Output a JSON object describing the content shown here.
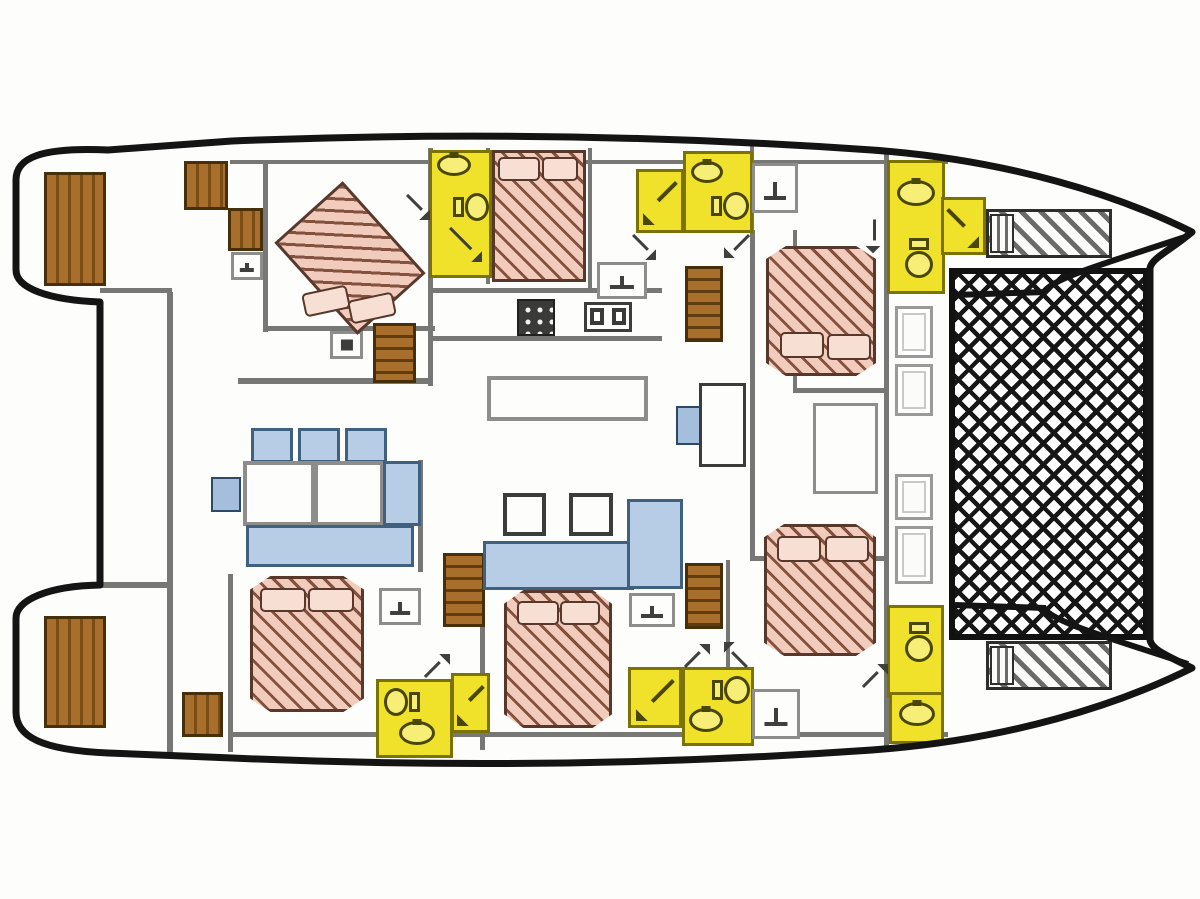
{
  "palette": {
    "wall": "#777775",
    "gray-line": "#8d8d8b",
    "dark-line": "#3c3c3a",
    "yellow": "#f0e22a",
    "yellow-lt": "#f6ee77",
    "yellow-line": "#7c7200",
    "glyph-y": "#4a4706",
    "glyph-g": "#3f3f3d",
    "blue": "#b7cde6",
    "blue-line": "#40607f",
    "window": "#a4bedc",
    "window-line": "#2c4a68",
    "bed": "#f1cbbc",
    "bed-stripe": "#84513f",
    "bed-line": "#59382c",
    "pillow": "#f7dfd4",
    "hull": "#141414"
  },
  "plan": {
    "width": 1200,
    "height": 899,
    "items": [
      {
        "n": "wall-top-deck",
        "t": "wall",
        "x": 230,
        "y": 160,
        "w": 718,
        "h": 4
      },
      {
        "n": "wall-fwd-port-cabin-left",
        "t": "wall",
        "x": 263,
        "y": 162,
        "w": 5,
        "h": 170
      },
      {
        "n": "wall-fwd-port-cabin-bottom",
        "t": "wall",
        "x": 263,
        "y": 326,
        "w": 172,
        "h": 5
      },
      {
        "n": "wall-mid-vertical",
        "t": "wall",
        "x": 428,
        "y": 148,
        "w": 5,
        "h": 238
      },
      {
        "n": "wall-port-lower",
        "t": "wall",
        "x": 238,
        "y": 378,
        "w": 194,
        "h": 6
      },
      {
        "n": "wall-stern-upper",
        "t": "wall",
        "x": 100,
        "y": 288,
        "w": 72,
        "h": 5
      },
      {
        "n": "wall-salon-left",
        "t": "wall",
        "x": 167,
        "y": 292,
        "w": 6,
        "h": 462
      },
      {
        "n": "wall-center-bed-right",
        "t": "wall",
        "x": 588,
        "y": 148,
        "w": 4,
        "h": 142
      },
      {
        "n": "wall-galley-top",
        "t": "wall",
        "x": 430,
        "y": 288,
        "w": 232,
        "h": 5
      },
      {
        "n": "wall-galley-bottom",
        "t": "wall",
        "x": 430,
        "y": 336,
        "w": 232,
        "h": 5
      },
      {
        "n": "wall-stbd-corridor-left",
        "t": "wall",
        "x": 750,
        "y": 230,
        "w": 5,
        "h": 330
      },
      {
        "n": "wall-stbd-corridor-right",
        "t": "wall",
        "x": 793,
        "y": 230,
        "w": 4,
        "h": 162
      },
      {
        "n": "wall-stbd-outer",
        "t": "wall",
        "x": 884,
        "y": 152,
        "w": 5,
        "h": 600
      },
      {
        "n": "wall-fwd-stbd-cabin-left",
        "t": "wall",
        "x": 750,
        "y": 140,
        "w": 4,
        "h": 95
      },
      {
        "n": "wall-stbd-mid-room-top",
        "t": "wall",
        "x": 793,
        "y": 388,
        "w": 95,
        "h": 5
      },
      {
        "n": "wall-aft-stbd-room-top",
        "t": "wall",
        "x": 750,
        "y": 556,
        "w": 138,
        "h": 5
      },
      {
        "n": "wall-aft-port-cabin-left",
        "t": "wall",
        "x": 228,
        "y": 574,
        "w": 5,
        "h": 178
      },
      {
        "n": "wall-bottom-deck",
        "t": "wall",
        "x": 228,
        "y": 732,
        "w": 720,
        "h": 5
      },
      {
        "n": "wall-aft-center-cabin-left",
        "t": "wall",
        "x": 480,
        "y": 590,
        "w": 5,
        "h": 160
      },
      {
        "n": "wall-aft-stbd-stairwell",
        "t": "wall",
        "x": 726,
        "y": 560,
        "w": 4,
        "h": 172
      },
      {
        "n": "wall-stern-lower",
        "t": "wall",
        "x": 100,
        "y": 582,
        "w": 72,
        "h": 6
      },
      {
        "n": "wall-fwd-bath-right",
        "t": "wall",
        "x": 486,
        "y": 148,
        "w": 4,
        "h": 136
      },
      {
        "n": "wall-dinette-right",
        "t": "wall",
        "x": 418,
        "y": 460,
        "w": 5,
        "h": 112
      },
      {
        "n": "wall-stbd-fwd-bath-divider",
        "t": "wall",
        "x": 887,
        "y": 232,
        "w": 58,
        "h": 4
      },
      {
        "n": "wall-stbd-aft-bath-divider",
        "t": "wall",
        "x": 887,
        "y": 692,
        "w": 57,
        "h": 4
      },
      {
        "n": "bathroom-fwd-port",
        "t": "bath-room",
        "x": 429,
        "y": 150,
        "w": 63,
        "h": 128
      },
      {
        "n": "shower-fwd-center",
        "t": "shower-room",
        "x": 636,
        "y": 169,
        "w": 48,
        "h": 64,
        "f": true
      },
      {
        "n": "bathroom-fwd-center",
        "t": "bath-room",
        "x": 683,
        "y": 151,
        "w": 70,
        "h": 82
      },
      {
        "n": "bathroom-fwd-stbd",
        "t": "bath-room",
        "x": 887,
        "y": 160,
        "w": 58,
        "h": 134
      },
      {
        "n": "shower-fwd-stbd",
        "t": "shower-room",
        "x": 941,
        "y": 197,
        "w": 45,
        "h": 58
      },
      {
        "n": "bathroom-aft-port",
        "t": "bath-room",
        "x": 376,
        "y": 679,
        "w": 77,
        "h": 79
      },
      {
        "n": "shower-aft-port",
        "t": "shower-room",
        "x": 451,
        "y": 673,
        "w": 39,
        "h": 60,
        "f": true
      },
      {
        "n": "shower-aft-center",
        "t": "shower-room",
        "x": 628,
        "y": 667,
        "w": 54,
        "h": 61,
        "f": true
      },
      {
        "n": "bathroom-aft-center",
        "t": "bath-room",
        "x": 682,
        "y": 667,
        "w": 72,
        "h": 79
      },
      {
        "n": "bathroom-aft-stbd",
        "t": "bath-room",
        "x": 887,
        "y": 605,
        "w": 57,
        "h": 92
      },
      {
        "n": "washroom-aft-stbd",
        "t": "bath-room",
        "x": 889,
        "y": 692,
        "w": 55,
        "h": 52
      },
      {
        "n": "toilet-fwd-port",
        "t": "toilet",
        "x": 453,
        "y": 193,
        "w": 36,
        "h": 28
      },
      {
        "n": "sink-fwd-port",
        "t": "sink-oval",
        "x": 437,
        "y": 154,
        "w": 34,
        "h": 22
      },
      {
        "n": "toilet-fwd-center",
        "t": "toilet",
        "x": 711,
        "y": 192,
        "w": 38,
        "h": 28
      },
      {
        "n": "sink-fwd-center",
        "t": "sink-oval",
        "x": 691,
        "y": 161,
        "w": 32,
        "h": 22
      },
      {
        "n": "toilet-fwd-stbd",
        "t": "toilet",
        "x": 899,
        "y": 244,
        "w": 40,
        "h": 28,
        "r": 90
      },
      {
        "n": "sink-fwd-stbd",
        "t": "sink-oval",
        "x": 897,
        "y": 180,
        "w": 38,
        "h": 26
      },
      {
        "n": "toilet-aft-port",
        "t": "toilet",
        "x": 384,
        "y": 688,
        "w": 36,
        "h": 28,
        "r": 180
      },
      {
        "n": "sink-aft-port",
        "t": "sink-oval",
        "x": 399,
        "y": 721,
        "w": 36,
        "h": 24
      },
      {
        "n": "toilet-aft-center",
        "t": "toilet",
        "x": 712,
        "y": 676,
        "w": 38,
        "h": 28
      },
      {
        "n": "sink-aft-center",
        "t": "sink-oval",
        "x": 689,
        "y": 708,
        "w": 34,
        "h": 24
      },
      {
        "n": "toilet-aft-stbd",
        "t": "toilet",
        "x": 899,
        "y": 628,
        "w": 40,
        "h": 28,
        "r": 90
      },
      {
        "n": "sink-aft-stbd",
        "t": "sink-oval",
        "x": 899,
        "y": 702,
        "w": 36,
        "h": 24
      },
      {
        "n": "swim-platform-port",
        "t": "wood",
        "x": 44,
        "y": 172,
        "w": 62,
        "h": 114
      },
      {
        "n": "steps-port-aft-1",
        "t": "wood",
        "x": 184,
        "y": 161,
        "w": 44,
        "h": 49
      },
      {
        "n": "steps-port-aft-2",
        "t": "wood",
        "x": 228,
        "y": 208,
        "w": 35,
        "h": 43
      },
      {
        "n": "stairs-port-fwd",
        "t": "stairs",
        "x": 373,
        "y": 323,
        "w": 43,
        "h": 60
      },
      {
        "n": "stairs-stbd-fwd",
        "t": "stairs",
        "x": 685,
        "y": 266,
        "w": 38,
        "h": 76
      },
      {
        "n": "stairs-port-aft",
        "t": "stairs",
        "x": 443,
        "y": 553,
        "w": 42,
        "h": 74
      },
      {
        "n": "stairs-stbd-aft",
        "t": "stairs",
        "x": 685,
        "y": 563,
        "w": 38,
        "h": 66
      },
      {
        "n": "swim-platform-stbd",
        "t": "wood",
        "x": 44,
        "y": 616,
        "w": 62,
        "h": 112
      },
      {
        "n": "steps-stbd-aft",
        "t": "wood",
        "x": 182,
        "y": 692,
        "w": 41,
        "h": 45
      },
      {
        "n": "trampoline-net",
        "t": "net",
        "x": 949,
        "y": 268,
        "w": 200,
        "h": 372
      },
      {
        "n": "bow-lounger-top",
        "t": "lounger",
        "x": 986,
        "y": 209,
        "w": 126,
        "h": 49
      },
      {
        "n": "bow-lounger-top-end",
        "t": "lounger-end",
        "x": 990,
        "y": 214,
        "w": 24,
        "h": 39
      },
      {
        "n": "bow-lounger-bottom",
        "t": "lounger",
        "x": 986,
        "y": 641,
        "w": 126,
        "h": 49
      },
      {
        "n": "bow-lounger-bottom-end",
        "t": "lounger-end",
        "x": 990,
        "y": 646,
        "w": 24,
        "h": 39
      },
      {
        "n": "deck-hatch-1",
        "t": "hatch",
        "x": 895,
        "y": 306,
        "w": 38,
        "h": 52
      },
      {
        "n": "deck-hatch-2",
        "t": "hatch",
        "x": 895,
        "y": 364,
        "w": 38,
        "h": 52
      },
      {
        "n": "deck-hatch-3",
        "t": "hatch",
        "x": 895,
        "y": 474,
        "w": 38,
        "h": 46
      },
      {
        "n": "deck-hatch-4",
        "t": "hatch",
        "x": 895,
        "y": 526,
        "w": 38,
        "h": 58
      },
      {
        "n": "dinette-seatback-1",
        "t": "blue",
        "x": 251,
        "y": 428,
        "w": 42,
        "h": 35
      },
      {
        "n": "dinette-seatback-2",
        "t": "blue",
        "x": 298,
        "y": 428,
        "w": 42,
        "h": 35
      },
      {
        "n": "dinette-seatback-3",
        "t": "blue",
        "x": 345,
        "y": 428,
        "w": 42,
        "h": 35
      },
      {
        "n": "dinette-table-left",
        "t": "table",
        "x": 243,
        "y": 461,
        "w": 72,
        "h": 65
      },
      {
        "n": "dinette-table-right",
        "t": "table",
        "x": 314,
        "y": 461,
        "w": 70,
        "h": 65
      },
      {
        "n": "dinette-side-seat",
        "t": "blue",
        "x": 383,
        "y": 461,
        "w": 38,
        "h": 65
      },
      {
        "n": "dinette-bench",
        "t": "blue",
        "x": 246,
        "y": 525,
        "w": 168,
        "h": 42
      },
      {
        "n": "salon-window-port",
        "t": "window",
        "x": 211,
        "y": 477,
        "w": 30,
        "h": 35
      },
      {
        "n": "salon-bench-horizontal",
        "t": "blue",
        "x": 483,
        "y": 541,
        "w": 151,
        "h": 49
      },
      {
        "n": "salon-bench-vertical",
        "t": "blue",
        "x": 627,
        "y": 499,
        "w": 56,
        "h": 90
      },
      {
        "n": "nav-seat",
        "t": "window",
        "x": 676,
        "y": 406,
        "w": 30,
        "h": 39
      },
      {
        "n": "salon-stool-1",
        "t": "stool",
        "x": 503,
        "y": 493,
        "w": 43,
        "h": 43
      },
      {
        "n": "salon-stool-2",
        "t": "stool",
        "x": 569,
        "y": 493,
        "w": 44,
        "h": 43
      },
      {
        "n": "galley-island",
        "t": "table",
        "x": 487,
        "y": 376,
        "w": 161,
        "h": 45
      },
      {
        "n": "nav-desk",
        "t": "navdesk",
        "x": 699,
        "y": 383,
        "w": 47,
        "h": 84
      },
      {
        "n": "stbd-mid-berth",
        "t": "berth",
        "x": 813,
        "y": 403,
        "w": 65,
        "h": 91
      },
      {
        "n": "tv-locker",
        "t": "tv",
        "x": 330,
        "y": 331,
        "w": 33,
        "h": 28
      },
      {
        "n": "vanity-galley",
        "t": "vanity",
        "x": 597,
        "y": 262,
        "w": 50,
        "h": 37
      },
      {
        "n": "vanity-fwd-stbd-corridor",
        "t": "vanity",
        "x": 752,
        "y": 163,
        "w": 46,
        "h": 50
      },
      {
        "n": "vanity-aft-stbd-corridor",
        "t": "vanity",
        "x": 752,
        "y": 689,
        "w": 48,
        "h": 50
      },
      {
        "n": "vanity-aft-port-cabin",
        "t": "vanity",
        "x": 379,
        "y": 588,
        "w": 42,
        "h": 37
      },
      {
        "n": "vanity-aft-center-cabin",
        "t": "vanity",
        "x": 629,
        "y": 593,
        "w": 46,
        "h": 34
      },
      {
        "n": "vanity-cockpit",
        "t": "vanity",
        "x": 231,
        "y": 252,
        "w": 32,
        "h": 28
      },
      {
        "n": "stove",
        "t": "stove",
        "x": 517,
        "y": 299,
        "w": 38,
        "h": 37
      },
      {
        "n": "galley-double-sink",
        "t": "sink2",
        "x": 584,
        "y": 302,
        "w": 48,
        "h": 30
      },
      {
        "n": "bed-fwd-port",
        "t": "bed",
        "x": 304,
        "y": 196,
        "w": 92,
        "h": 124,
        "r": -42
      },
      {
        "n": "pillow-fwd-port-1",
        "t": "pillow",
        "x": 303,
        "y": 289,
        "w": 46,
        "h": 24,
        "r": -12
      },
      {
        "n": "pillow-fwd-port-2",
        "t": "pillow",
        "x": 349,
        "y": 296,
        "w": 46,
        "h": 24,
        "r": -12
      },
      {
        "n": "bed-fwd-center",
        "t": "bed",
        "x": 492,
        "y": 150,
        "w": 94,
        "h": 132
      },
      {
        "n": "pillow-fwd-center-1",
        "t": "pillow",
        "x": 498,
        "y": 157,
        "w": 42,
        "h": 24
      },
      {
        "n": "pillow-fwd-center-2",
        "t": "pillow",
        "x": 542,
        "y": 157,
        "w": 36,
        "h": 24
      },
      {
        "n": "bed-fwd-stbd",
        "t": "bed",
        "x": 766,
        "y": 246,
        "w": 110,
        "h": 130,
        "c": "polygon(0 10%,18% 0,82% 0,100% 10%,100% 90%,82% 100%,18% 100%,0 90%)"
      },
      {
        "n": "pillow-fwd-stbd-1",
        "t": "pillow",
        "x": 780,
        "y": 332,
        "w": 44,
        "h": 26
      },
      {
        "n": "pillow-fwd-stbd-2",
        "t": "pillow",
        "x": 827,
        "y": 334,
        "w": 44,
        "h": 26
      },
      {
        "n": "bed-aft-stbd",
        "t": "bed",
        "x": 764,
        "y": 524,
        "w": 112,
        "h": 132,
        "c": "polygon(0 10%,18% 0,82% 0,100% 10%,100% 90%,82% 100%,18% 100%,0 90%)"
      },
      {
        "n": "pillow-aft-stbd-1",
        "t": "pillow",
        "x": 777,
        "y": 536,
        "w": 44,
        "h": 26
      },
      {
        "n": "pillow-aft-stbd-2",
        "t": "pillow",
        "x": 825,
        "y": 536,
        "w": 44,
        "h": 26
      },
      {
        "n": "bed-aft-port",
        "t": "bed",
        "x": 250,
        "y": 576,
        "w": 114,
        "h": 136,
        "c": "polygon(0 10%,18% 0,82% 0,100% 10%,100% 90%,82% 100%,18% 100%,0 90%)"
      },
      {
        "n": "pillow-aft-port-1",
        "t": "pillow",
        "x": 260,
        "y": 588,
        "w": 46,
        "h": 24
      },
      {
        "n": "pillow-aft-port-2",
        "t": "pillow",
        "x": 308,
        "y": 588,
        "w": 46,
        "h": 24
      },
      {
        "n": "bed-aft-center",
        "t": "bed",
        "x": 504,
        "y": 590,
        "w": 108,
        "h": 138,
        "c": "polygon(0 10%,18% 0,82% 0,100% 10%,100% 90%,82% 100%,18% 100%,0 90%)"
      },
      {
        "n": "pillow-aft-center-1",
        "t": "pillow",
        "x": 517,
        "y": 601,
        "w": 42,
        "h": 24
      },
      {
        "n": "pillow-aft-center-2",
        "t": "pillow",
        "x": 560,
        "y": 601,
        "w": 40,
        "h": 24
      },
      {
        "n": "door-arrow-fwd-port",
        "t": "door-arrow",
        "x": 404,
        "y": 194,
        "w": 26,
        "h": 26,
        "r": 90
      },
      {
        "n": "shower-arrow-fwd-port",
        "t": "door-arrow",
        "x": 446,
        "y": 226,
        "w": 36,
        "h": 36,
        "r": 90
      },
      {
        "n": "door-arrow-fwd-center-1",
        "t": "door-arrow",
        "x": 630,
        "y": 234,
        "w": 26,
        "h": 26,
        "r": 90
      },
      {
        "n": "door-arrow-fwd-center-2",
        "t": "door-arrow",
        "x": 724,
        "y": 232,
        "w": 26,
        "h": 26,
        "r": 180
      },
      {
        "n": "door-arrow-fwd-stbd",
        "t": "door-arrow",
        "x": 860,
        "y": 222,
        "w": 26,
        "h": 26,
        "r": 135
      },
      {
        "n": "door-arrow-aft-port",
        "t": "door-arrow",
        "x": 424,
        "y": 654,
        "w": 26,
        "h": 26
      },
      {
        "n": "door-arrow-aft-center-1",
        "t": "door-arrow",
        "x": 684,
        "y": 644,
        "w": 26,
        "h": 26
      },
      {
        "n": "door-arrow-aft-center-2",
        "t": "door-arrow",
        "x": 724,
        "y": 642,
        "w": 26,
        "h": 26,
        "r": -90
      },
      {
        "n": "door-arrow-aft-stbd",
        "t": "door-arrow",
        "x": 862,
        "y": 664,
        "w": 26,
        "h": 26
      }
    ]
  }
}
